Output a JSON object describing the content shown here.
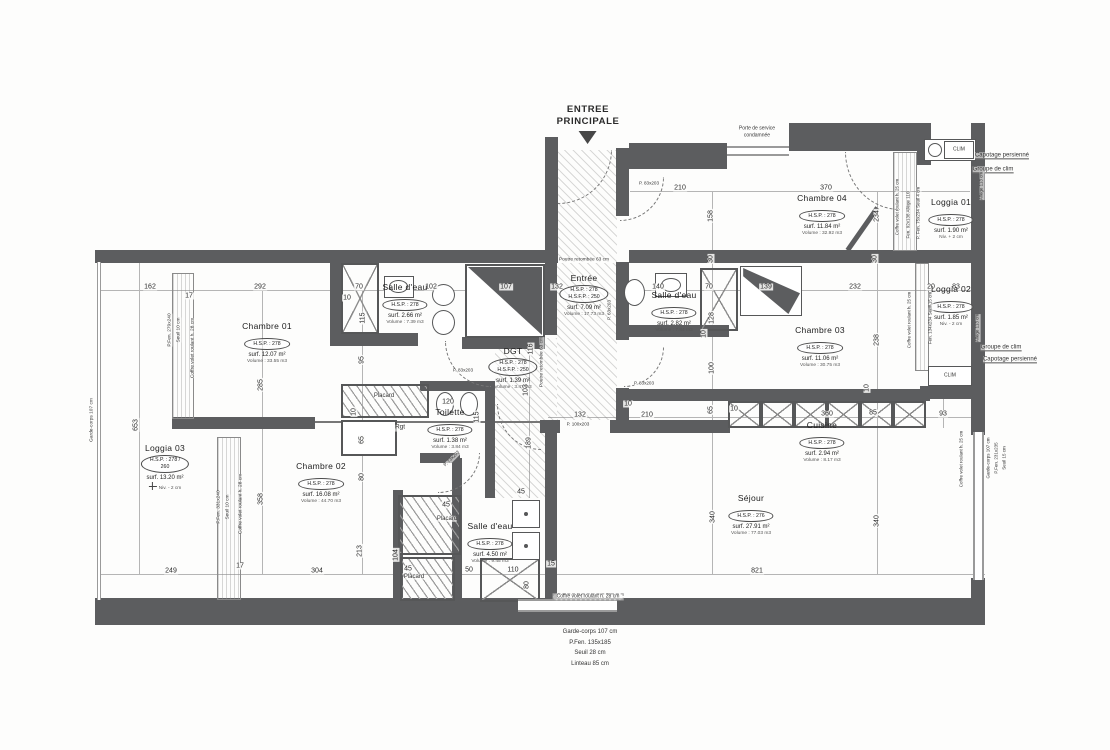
{
  "entrance": {
    "line1": "ENTREE",
    "line2": "PRINCIPALE"
  },
  "rooms": [
    {
      "id": "chambre-01",
      "name": "Chambre 01",
      "badge": [
        "H.S.P. : 278"
      ],
      "lines": [
        "surf. 12.07 m²",
        "Volume : 33.55 m3"
      ],
      "x": 267,
      "y": 322
    },
    {
      "id": "salle-d-eau-1",
      "name": "Salle d'eau",
      "badge": [
        "H.S.P. : 278"
      ],
      "lines": [
        "surf. 2.66 m²",
        "Volume : 7.39 m3"
      ],
      "x": 405,
      "y": 283
    },
    {
      "id": "entree",
      "name": "Entrée",
      "badge": [
        "H.S.P. : 278",
        "H.S.F.P. : 250"
      ],
      "lines": [
        "surf. 7.09 m²",
        "Volume : 17.73 m3"
      ],
      "x": 584,
      "y": 274
    },
    {
      "id": "chambre-04",
      "name": "Chambre 04",
      "badge": [
        "H.S.P. : 278"
      ],
      "lines": [
        "surf. 11.84 m²",
        "Volume : 32.92 m3"
      ],
      "x": 822,
      "y": 194
    },
    {
      "id": "loggia-01",
      "name": "Loggia 01",
      "badge": [
        "H.S.P. : 278"
      ],
      "lines": [
        "surf. 1.90 m²",
        "Niv. + 2 cm"
      ],
      "x": 951,
      "y": 198
    },
    {
      "id": "salle-d-eau-2",
      "name": "Salle d'eau",
      "badge": [
        "H.S.P. : 278"
      ],
      "lines": [
        "surf. 2.82 m²",
        "Volume : 7.84 m3"
      ],
      "x": 674,
      "y": 291
    },
    {
      "id": "chambre-03",
      "name": "Chambre 03",
      "badge": [
        "H.S.P. : 278"
      ],
      "lines": [
        "surf. 11.06 m²",
        "Volume : 30.75 m3"
      ],
      "x": 820,
      "y": 326
    },
    {
      "id": "loggia-02",
      "name": "Loggia 02",
      "badge": [
        "H.S.P. : 278"
      ],
      "lines": [
        "surf. 1.85 m²",
        "Niv. - 2 cm"
      ],
      "x": 951,
      "y": 285
    },
    {
      "id": "dgt",
      "name": "DGT",
      "badge": [
        "H.S.P. : 278",
        "H.S.F.P. : 250"
      ],
      "lines": [
        "surf. 1.39 m²",
        "Volume : 3.47 m3"
      ],
      "x": 513,
      "y": 347
    },
    {
      "id": "toilette",
      "name": "Toilette",
      "badge": [
        "H.S.P. : 278"
      ],
      "lines": [
        "surf. 1.38 m²",
        "Volume : 3.84 m3"
      ],
      "x": 450,
      "y": 408
    },
    {
      "id": "loggia-03",
      "name": "Loggia 03",
      "badge": [
        "H.S.P. : 278 /",
        "260"
      ],
      "lines": [
        "surf. 13.20 m²",
        "Niv. - 2 cm"
      ],
      "north": true,
      "x": 165,
      "y": 444
    },
    {
      "id": "chambre-02",
      "name": "Chambre 02",
      "badge": [
        "H.S.P. : 278"
      ],
      "lines": [
        "surf. 16.08 m²",
        "Volume : 44.70 m3"
      ],
      "x": 321,
      "y": 462
    },
    {
      "id": "salle-d-eau-3",
      "name": "Salle d'eau",
      "badge": [
        "H.S.P. : 278"
      ],
      "lines": [
        "surf. 4.50 m²",
        "Volume : 9.45 m3"
      ],
      "x": 490,
      "y": 522
    },
    {
      "id": "cuisine",
      "name": "Cuisine",
      "badge": [
        "H.S.P. : 278"
      ],
      "lines": [
        "surf. 2.94 m²",
        "Volume : 8.17 m3"
      ],
      "x": 822,
      "y": 421
    },
    {
      "id": "sejour",
      "name": "Séjour",
      "badge": [
        "H.S.P. : 276"
      ],
      "lines": [
        "surf. 27.91 m²",
        "Volume : 77.03 m3"
      ],
      "x": 751,
      "y": 494
    }
  ],
  "dims": [
    [
      "162",
      150,
      287,
      0
    ],
    [
      "17",
      189,
      296,
      0
    ],
    [
      "292",
      260,
      287,
      0
    ],
    [
      "70",
      359,
      287,
      0
    ],
    [
      "10",
      347,
      298,
      0
    ],
    [
      "115",
      363,
      318,
      1
    ],
    [
      "95",
      362,
      360,
      1
    ],
    [
      "102",
      431,
      287,
      0
    ],
    [
      "107",
      506,
      287,
      0
    ],
    [
      "132",
      557,
      287,
      0
    ],
    [
      "140",
      658,
      287,
      0
    ],
    [
      "70",
      709,
      287,
      0
    ],
    [
      "128",
      712,
      318,
      1
    ],
    [
      "10",
      704,
      334,
      1
    ],
    [
      "100",
      712,
      368,
      1
    ],
    [
      "139",
      766,
      287,
      0
    ],
    [
      "232",
      855,
      287,
      0
    ],
    [
      "20",
      931,
      287,
      0
    ],
    [
      "83",
      956,
      287,
      0
    ],
    [
      "210",
      680,
      188,
      0
    ],
    [
      "370",
      826,
      188,
      0
    ],
    [
      "158",
      711,
      216,
      1
    ],
    [
      "234",
      877,
      216,
      1
    ],
    [
      "30",
      711,
      259,
      1
    ],
    [
      "30",
      875,
      259,
      1
    ],
    [
      "238",
      877,
      340,
      1
    ],
    [
      "10",
      867,
      388,
      1
    ],
    [
      "285",
      261,
      385,
      1
    ],
    [
      "653",
      136,
      425,
      1
    ],
    [
      "10",
      354,
      412,
      1
    ],
    [
      "65",
      362,
      440,
      1
    ],
    [
      "80",
      362,
      477,
      1
    ],
    [
      "213",
      360,
      551,
      1
    ],
    [
      "358",
      261,
      499,
      1
    ],
    [
      "120",
      448,
      402,
      0
    ],
    [
      "115",
      477,
      417,
      1
    ],
    [
      "116",
      531,
      349,
      1
    ],
    [
      "103",
      526,
      390,
      1
    ],
    [
      "189",
      529,
      443,
      1
    ],
    [
      "45",
      521,
      492,
      0
    ],
    [
      "132",
      580,
      415,
      0
    ],
    [
      "10",
      628,
      404,
      0
    ],
    [
      "210",
      647,
      415,
      0
    ],
    [
      "65",
      711,
      410,
      1
    ],
    [
      "10",
      734,
      409,
      0
    ],
    [
      "360",
      827,
      414,
      0
    ],
    [
      "85",
      873,
      413,
      0
    ],
    [
      "93",
      943,
      414,
      0
    ],
    [
      "340",
      713,
      517,
      1
    ],
    [
      "340",
      877,
      521,
      1
    ],
    [
      "45",
      446,
      505,
      0
    ],
    [
      "104",
      396,
      555,
      1
    ],
    [
      "45",
      408,
      569,
      0
    ],
    [
      "249",
      171,
      571,
      0
    ],
    [
      "17",
      240,
      566,
      0
    ],
    [
      "304",
      317,
      571,
      0
    ],
    [
      "50",
      469,
      570,
      0
    ],
    [
      "110",
      513,
      570,
      0
    ],
    [
      "15",
      551,
      564,
      0
    ],
    [
      "80",
      527,
      585,
      1
    ],
    [
      "821",
      757,
      571,
      0
    ]
  ],
  "annotations": [
    {
      "t": "Porte de service",
      "x": 757,
      "y": 129,
      "s": 5
    },
    {
      "t": "condamnée",
      "x": 757,
      "y": 136,
      "s": 5
    },
    {
      "t": "Capotage persienné",
      "x": 1002,
      "y": 156,
      "s": 6,
      "cls": "ul"
    },
    {
      "t": "Groupe de clim",
      "x": 993,
      "y": 170,
      "s": 6,
      "cls": "ul"
    },
    {
      "t": "Groupe de clim",
      "x": 1001,
      "y": 348,
      "s": 6,
      "cls": "ul"
    },
    {
      "t": "Capotage persienné",
      "x": 1010,
      "y": 360,
      "s": 6,
      "cls": "ul"
    },
    {
      "t": "Poutre retombée 63 cm",
      "x": 584,
      "y": 260,
      "s": 4.8
    },
    {
      "t": "Coffre volet roulant h. 28 cm",
      "x": 588,
      "y": 597,
      "s": 5,
      "cls": "boxed"
    },
    {
      "t": "Placard",
      "x": 384,
      "y": 396,
      "s": 6
    },
    {
      "t": "Rgt",
      "x": 400,
      "y": 428,
      "s": 6.5
    },
    {
      "t": "Placard",
      "x": 447,
      "y": 519,
      "s": 6
    },
    {
      "t": "Placard",
      "x": 414,
      "y": 577,
      "s": 6
    },
    {
      "t": "CLIM",
      "x": 959,
      "y": 150,
      "s": 5
    },
    {
      "t": "CLIM",
      "x": 950,
      "y": 376,
      "s": 5
    },
    {
      "t": "P. 83x203",
      "x": 649,
      "y": 184,
      "s": 4.6
    },
    {
      "t": "P. 63x203",
      "x": 610,
      "y": 310,
      "s": 4.6,
      "r": -90
    },
    {
      "t": "P. 83x203",
      "x": 463,
      "y": 371,
      "s": 4.6
    },
    {
      "t": "P. 83x203",
      "x": 644,
      "y": 384,
      "s": 4.6
    },
    {
      "t": "P. 100x203",
      "x": 578,
      "y": 425,
      "s": 4.6
    },
    {
      "t": "P. 73x203",
      "x": 452,
      "y": 459,
      "s": 4.6,
      "r": -45
    },
    {
      "t": "Garde-corps 107 cm",
      "x": 92,
      "y": 420,
      "s": 4.8,
      "r": -90
    },
    {
      "t": "P.Fen. 279x240",
      "x": 170,
      "y": 330,
      "s": 4.8,
      "r": -90
    },
    {
      "t": "Seuil 10 cm",
      "x": 179,
      "y": 330,
      "s": 4.8,
      "r": -90
    },
    {
      "t": "Coffre volet roulant h. 28 cm",
      "x": 193,
      "y": 348,
      "s": 4.8,
      "r": -90
    },
    {
      "t": "P.Fen. 331x240",
      "x": 219,
      "y": 507,
      "s": 4.8,
      "r": -90
    },
    {
      "t": "Seuil 10 cm",
      "x": 228,
      "y": 507,
      "s": 4.8,
      "r": -90
    },
    {
      "t": "Coffre volet roulant h. 28 cm",
      "x": 241,
      "y": 504,
      "s": 4.8,
      "r": -90
    },
    {
      "t": "Poutre retombée 63 cm",
      "x": 542,
      "y": 362,
      "s": 4.8,
      "r": -90
    },
    {
      "t": "Coffre volet roulant h. 25 cm",
      "x": 898,
      "y": 207,
      "s": 4.5,
      "r": -90
    },
    {
      "t": "Fen. 92x138  Allège 110",
      "x": 909,
      "y": 215,
      "s": 4.5,
      "r": -90
    },
    {
      "t": "P. Fen. 75x234  Seuil 4 cm",
      "x": 919,
      "y": 213,
      "s": 4.5,
      "r": -90
    },
    {
      "t": "Allège 113 cm",
      "x": 982,
      "y": 186,
      "s": 4.5,
      "r": -90
    },
    {
      "t": "Coffre volet roulant h. 25 cm",
      "x": 910,
      "y": 320,
      "s": 4.5,
      "r": -90
    },
    {
      "t": "Fen. 134x234  Seuil 15 cm",
      "x": 931,
      "y": 318,
      "s": 4.5,
      "r": -90
    },
    {
      "t": "Allège 113 cm",
      "x": 978,
      "y": 328,
      "s": 4.5,
      "r": -90
    },
    {
      "t": "Coffre volet roulant h. 25 cm",
      "x": 962,
      "y": 459,
      "s": 4.5,
      "r": -90
    },
    {
      "t": "Garde-corps 107 cm",
      "x": 989,
      "y": 458,
      "s": 4.5,
      "r": -90
    },
    {
      "t": "P.Fen. 231x235",
      "x": 997,
      "y": 458,
      "s": 4.5,
      "r": -90
    },
    {
      "t": "Seuil 15 cm",
      "x": 1005,
      "y": 458,
      "s": 4.5,
      "r": -90
    }
  ],
  "notes_bottom": [
    "Garde-corps 107 cm",
    "P.Fen. 135x185",
    "Seuil 28 cm",
    "Linteau 85 cm"
  ]
}
